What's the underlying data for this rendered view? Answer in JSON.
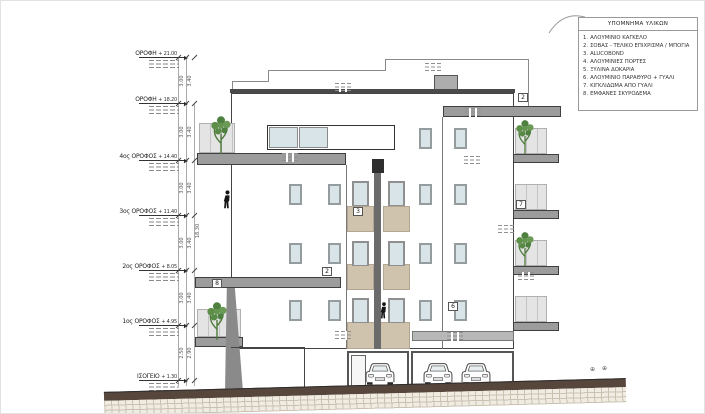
{
  "legend": {
    "title": "ΥΠΟΜΝΗΜΑ ΥΛΙΚΩΝ",
    "items": [
      {
        "num": "1.",
        "label": "ΑΛΟΥΜΙΝΙΟ ΚΑΓΚΕΛΟ"
      },
      {
        "num": "2.",
        "label": "ΣΟΒΑΣ - ΤΕΛΙΚΟ ΕΠΙΧΡΙΣΜΑ / ΜΠΟΓΙΑ"
      },
      {
        "num": "3.",
        "label": "ALUCOBOND"
      },
      {
        "num": "4.",
        "label": "ΑΛΟΥΜΙΝΙΕΣ ΠΟΡΤΕΣ"
      },
      {
        "num": "5.",
        "label": "ΞΥΛΙΝΑ ΔΟΚΑΡΙΑ"
      },
      {
        "num": "6.",
        "label": "ΑΛΟΥΜΙΝΙΟ ΠΑΡΑΘΥΡΟ + ΓΥΑΛΙ"
      },
      {
        "num": "7.",
        "label": "ΚΙΓΚΛΙΔΩΜΑ ΑΠΟ ΓΥΑΛΙ"
      },
      {
        "num": "8.",
        "label": "ΕΜΦΑΝΕΣ ΣΚΥΡΟΔΕΜΑ"
      }
    ]
  },
  "levels": [
    {
      "label": "ΟΡΟΦΗ",
      "elev": "+ 21.00"
    },
    {
      "label": "ΟΡΟΦΗ",
      "elev": "+ 18.20"
    },
    {
      "label": "4ος ΟΡΟΦΟΣ",
      "elev": "+ 14.40"
    },
    {
      "label": "3ος ΟΡΟΦΟΣ",
      "elev": "+ 11.40"
    },
    {
      "label": "2ος ΟΡΟΦΟΣ",
      "elev": "+ 8.05"
    },
    {
      "label": "1ος ΟΡΟΦΟΣ",
      "elev": "+ 4.95"
    },
    {
      "label": "ΙΣΟΓΕΙΟ",
      "elev": "+ 1.30"
    }
  ],
  "dims": {
    "floor": "3.00",
    "slab": "3.40",
    "ground_a": "2.50",
    "ground_b": "2.90",
    "overall": "18.30"
  },
  "callouts": [
    {
      "num": "2"
    },
    {
      "num": "7"
    },
    {
      "num": "8"
    },
    {
      "num": "2"
    },
    {
      "num": "3"
    },
    {
      "num": "6"
    }
  ],
  "icons": {
    "survey_marker": "⊕"
  },
  "colors": {
    "wall": "#ffffff",
    "outline": "#444444",
    "balcony_slab": "#9c9c9c",
    "alucobond_panel": "#cfc3ae",
    "window_glass": "#d9e4e8",
    "glass_railing": "#e4e4e4",
    "road": "#57463c",
    "plant_green": "#5d8f49"
  }
}
